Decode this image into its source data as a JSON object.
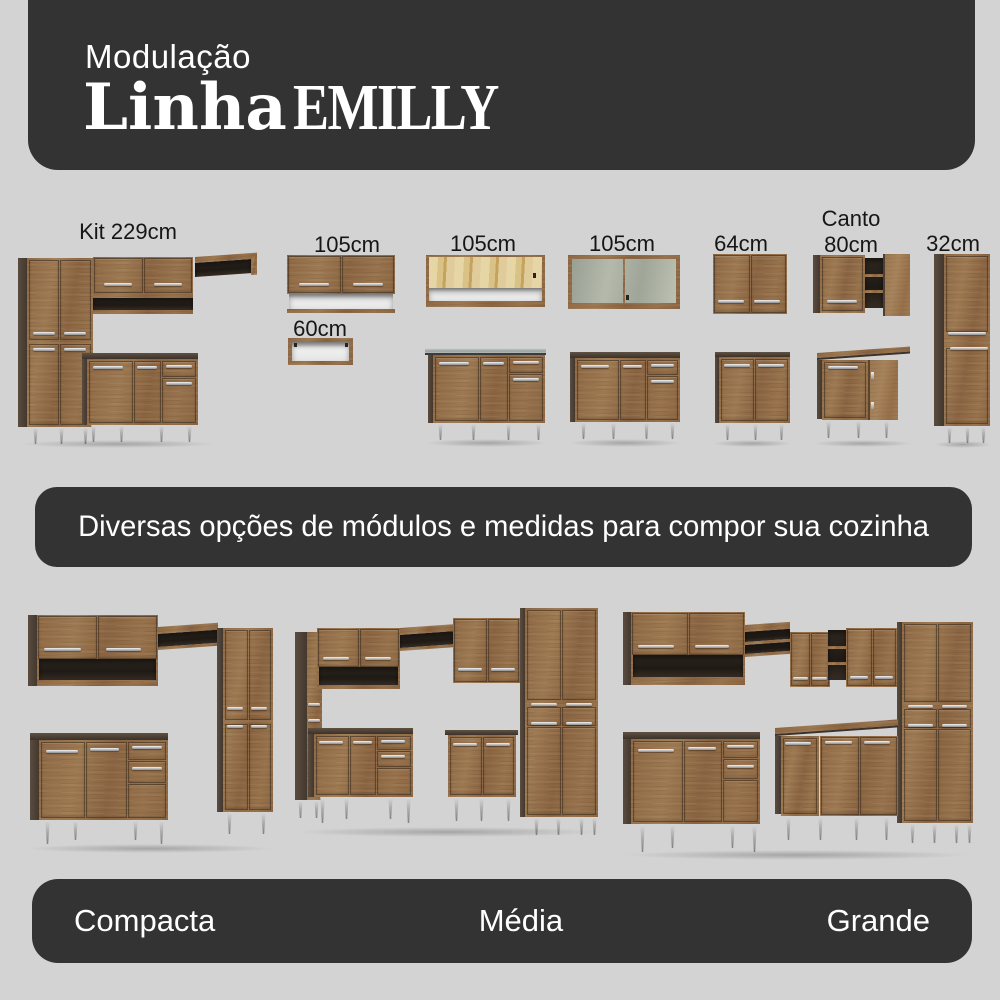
{
  "colors": {
    "background": "#d3d3d3",
    "banner": "#333333",
    "banner_text": "#ffffff",
    "label_text": "#161616",
    "wood": "#8e6844",
    "wood_dark_side": "#4e4237",
    "handle_silver": "#cfcfcf",
    "leg_silver": "#b5b5b5"
  },
  "header": {
    "kicker": "Modulação",
    "title_bold": "Linha",
    "title_light": "EMILLY"
  },
  "modules": [
    {
      "label": "Kit 229cm"
    },
    {
      "label": "105cm",
      "sublabel": "60cm"
    },
    {
      "label": "105cm"
    },
    {
      "label": "105cm"
    },
    {
      "label": "64cm"
    },
    {
      "label_line1": "Canto",
      "label_line2": "80cm"
    },
    {
      "label": "32cm"
    }
  ],
  "mid_banner": {
    "text": "Diversas opções de módulos e medidas para compor sua cozinha"
  },
  "bottom_banner": {
    "labels": [
      "Compacta",
      "Média",
      "Grande"
    ]
  }
}
